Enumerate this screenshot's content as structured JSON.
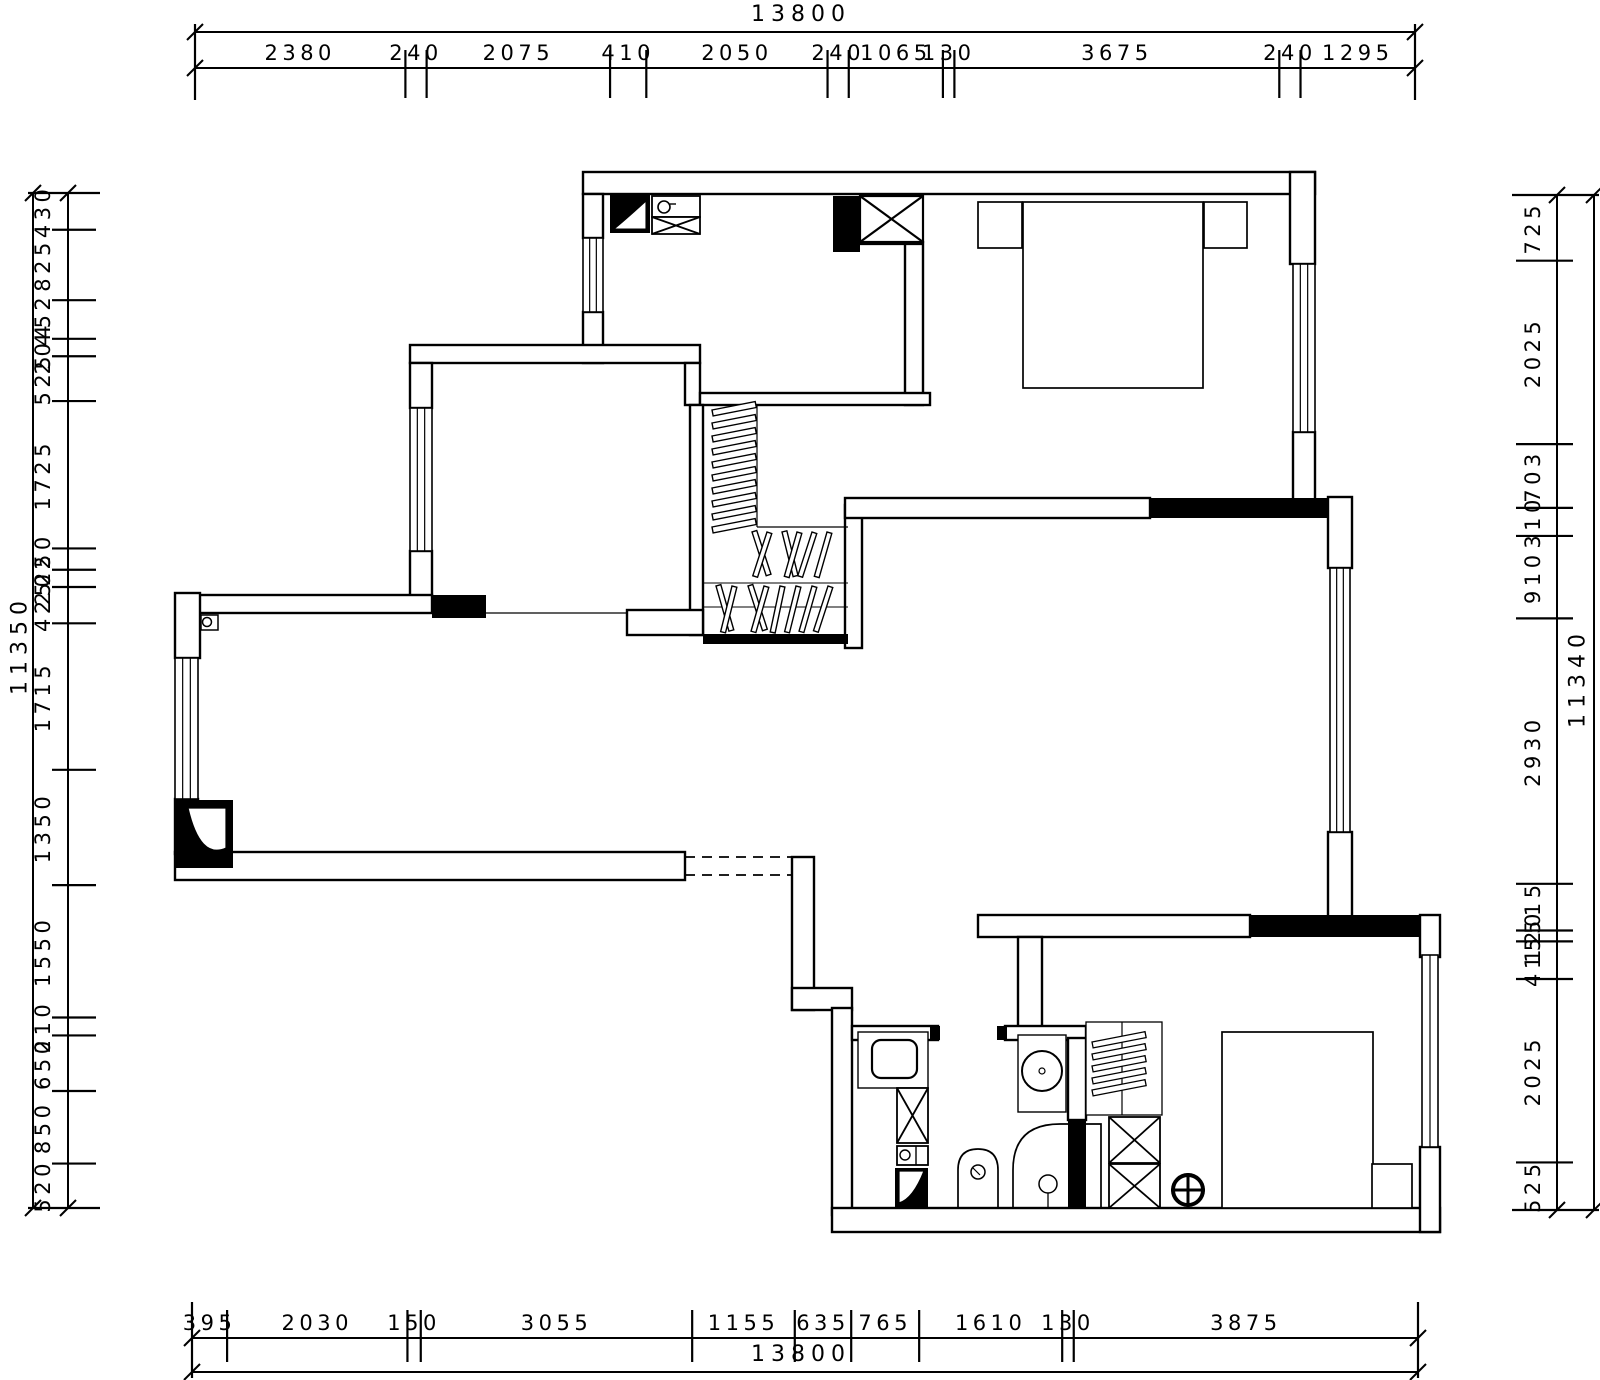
{
  "drawing_type": "architectural-floor-plan",
  "rulers": {
    "top": {
      "total": "13800",
      "segments": [
        "2380",
        "240",
        "2075",
        "410",
        "2050",
        "240",
        "1065",
        "130",
        "3675",
        "240",
        "1295"
      ]
    },
    "bottom": {
      "total": "13800",
      "segments": [
        "395",
        "2030",
        "150",
        "3055",
        "1155",
        "635",
        "765",
        "1610",
        "130",
        "3875"
      ]
    },
    "left": {
      "total": "11350",
      "segments": [
        "430",
        "825",
        "452",
        "204",
        "525",
        "1725",
        "250",
        "202",
        "425",
        "1715",
        "1350",
        "1550",
        "210",
        "650",
        "850",
        "520"
      ]
    },
    "right": {
      "total": "11340",
      "segments": [
        "725",
        "2025",
        "703",
        "310",
        "910",
        "2930",
        "515",
        "120",
        "415",
        "2025",
        "525"
      ]
    }
  },
  "symbols": [
    "refrigerator-icon",
    "kitchen-appliance-icon",
    "flue-shaft-icon",
    "double-bed-icon",
    "nightstand-icon",
    "walkin-closet-hangers-icon",
    "entry-door-icon",
    "corner-column-icon",
    "structural-column-icon",
    "bathroom-sink-icon",
    "washing-machine-icon",
    "duct-shaft-icon",
    "water-heater-icon",
    "toilet-icon",
    "shower-icon",
    "floor-drain-icon",
    "wardrobe-hangers-icon",
    "single-bed-icon",
    "window-icon",
    "dashed-opening"
  ],
  "colors": {
    "line": "#000000",
    "background": "#ffffff",
    "wall_fill": "#ffffff",
    "column_fill": "#000000"
  }
}
